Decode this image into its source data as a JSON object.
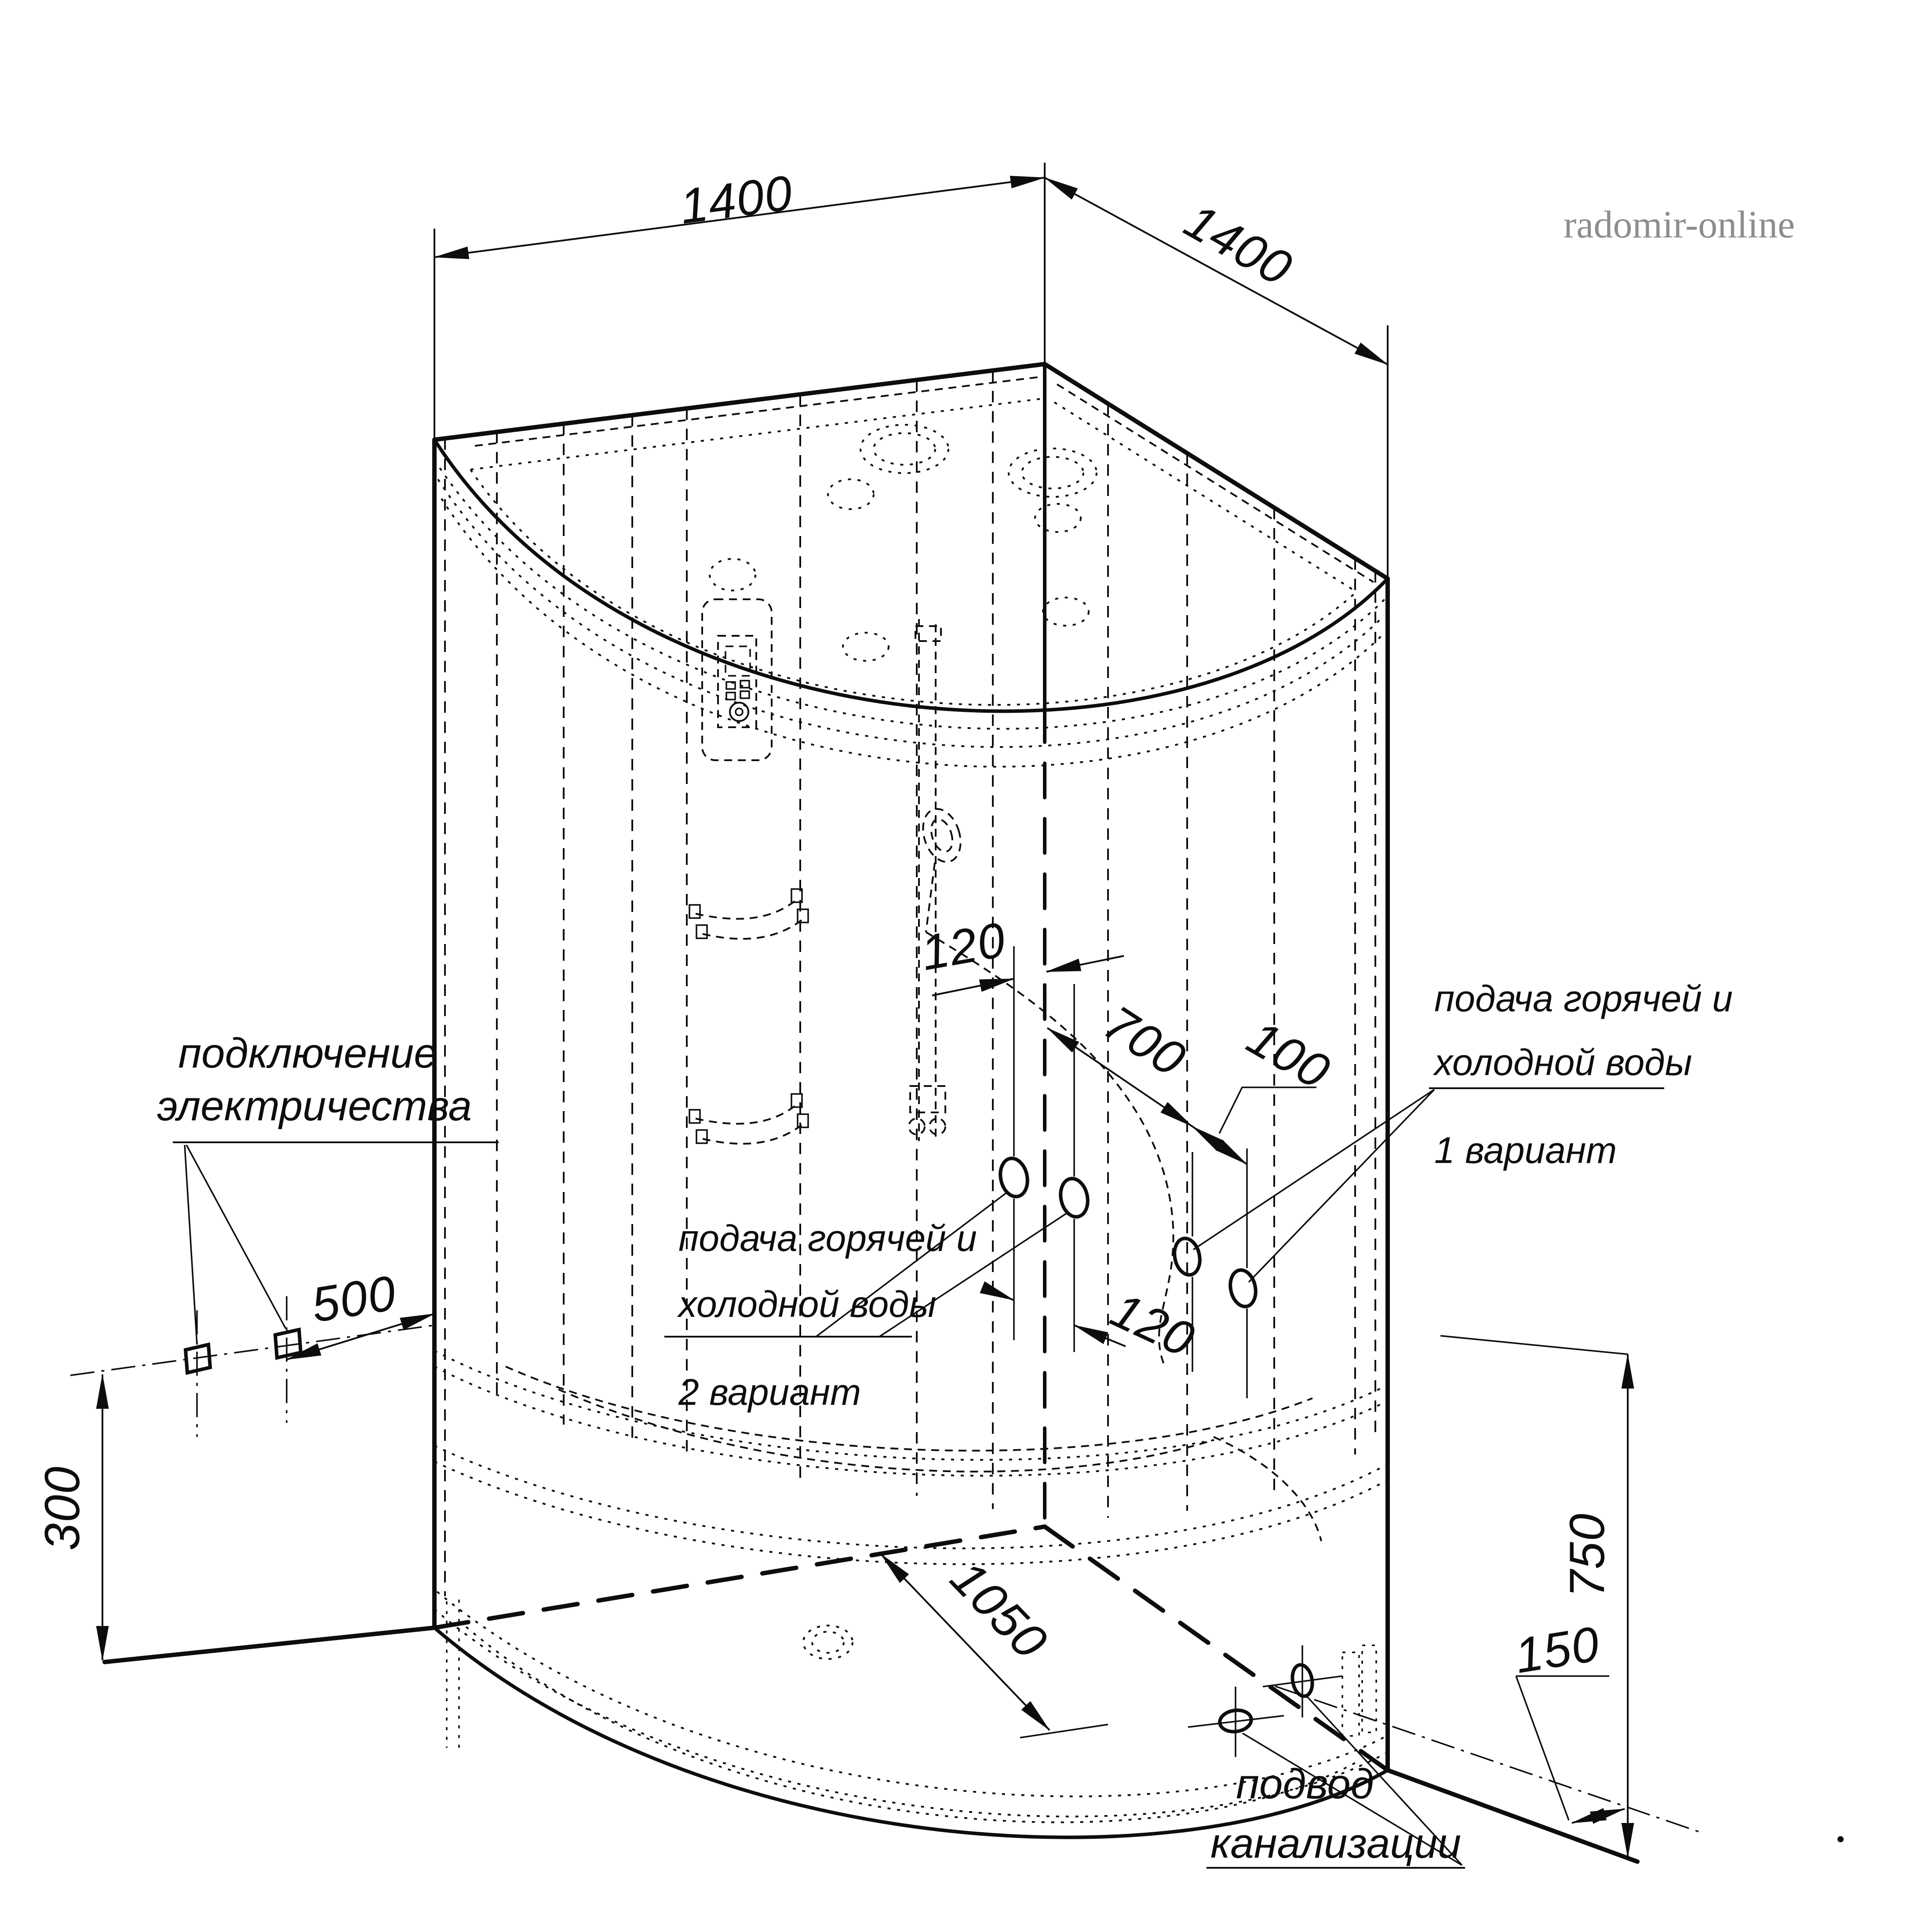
{
  "watermark": "radomir-online",
  "dims": {
    "top_left": "1400",
    "top_right": "1400",
    "electric_offset": "500",
    "electric_height": "300",
    "jet_offset": "120",
    "water_span": "700",
    "water_gap": "100",
    "water_pair_gap": "120",
    "tub_diagonal": "1050",
    "tub_height": "750",
    "drain_offset": "150"
  },
  "labels": {
    "electric": {
      "line1": "подключение",
      "line2": "электричества"
    },
    "water1": {
      "line1": "подача горячей и",
      "line2": "холодной воды",
      "variant": "1 вариант"
    },
    "water2": {
      "line1": "подача горячей и",
      "line2": "холодной воды",
      "variant": "2 вариант"
    },
    "sewage": {
      "line1": "подвод",
      "line2": "канализации"
    }
  }
}
